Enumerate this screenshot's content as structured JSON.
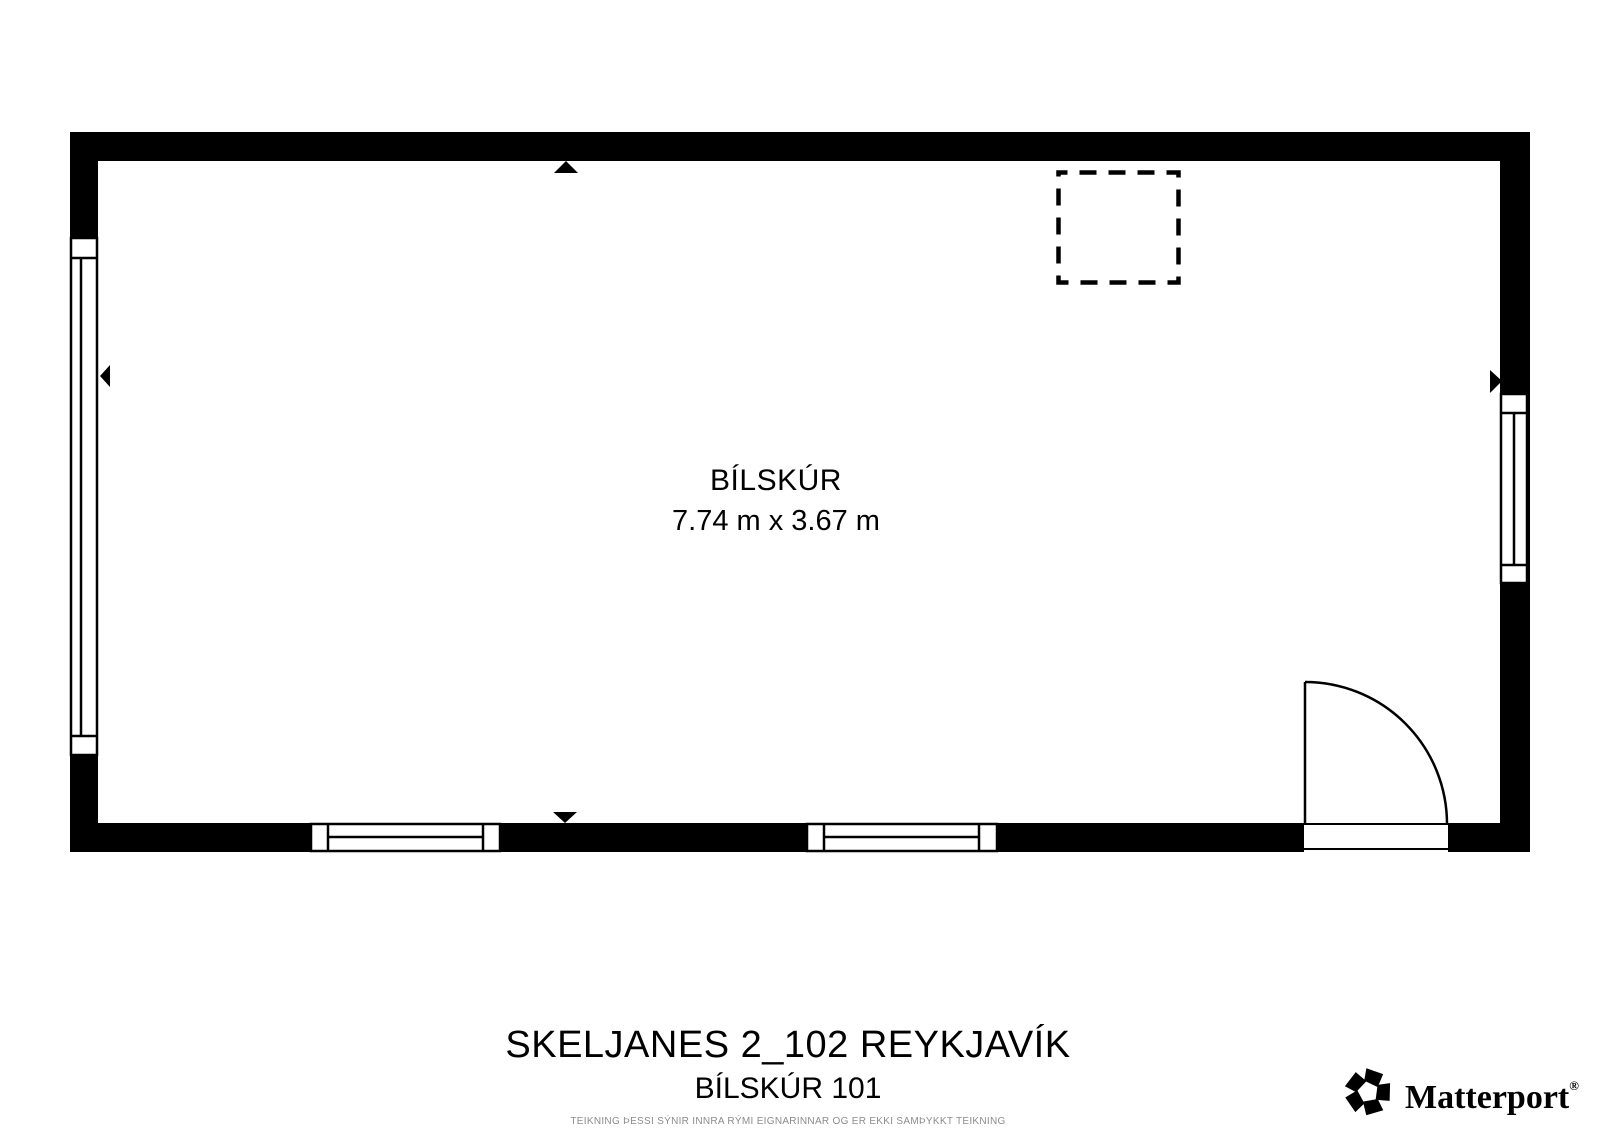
{
  "floor_plan": {
    "room": {
      "name": "BÍLSKÚR",
      "dimensions": "7.74 m x 3.67 m"
    }
  },
  "footer": {
    "title": "SKELJANES 2_102 REYKJAVÍK",
    "subtitle": "BÍLSKÚR 101",
    "disclaimer": "TEIKNING ÞESSI SÝNIR INNRA RÝMI EIGNARINNAR OG ER EKKI SAMÞYKKT TEIKNING"
  },
  "branding": {
    "logo_text": "Matterport",
    "registered": "®"
  },
  "icons": {
    "brand_mark": "matterport-pinwheel-icon",
    "direction_marker": "solid-black-triangle"
  },
  "colors": {
    "line": "#000000",
    "background": "#ffffff",
    "disclaimer_text": "#8c8c8c"
  }
}
